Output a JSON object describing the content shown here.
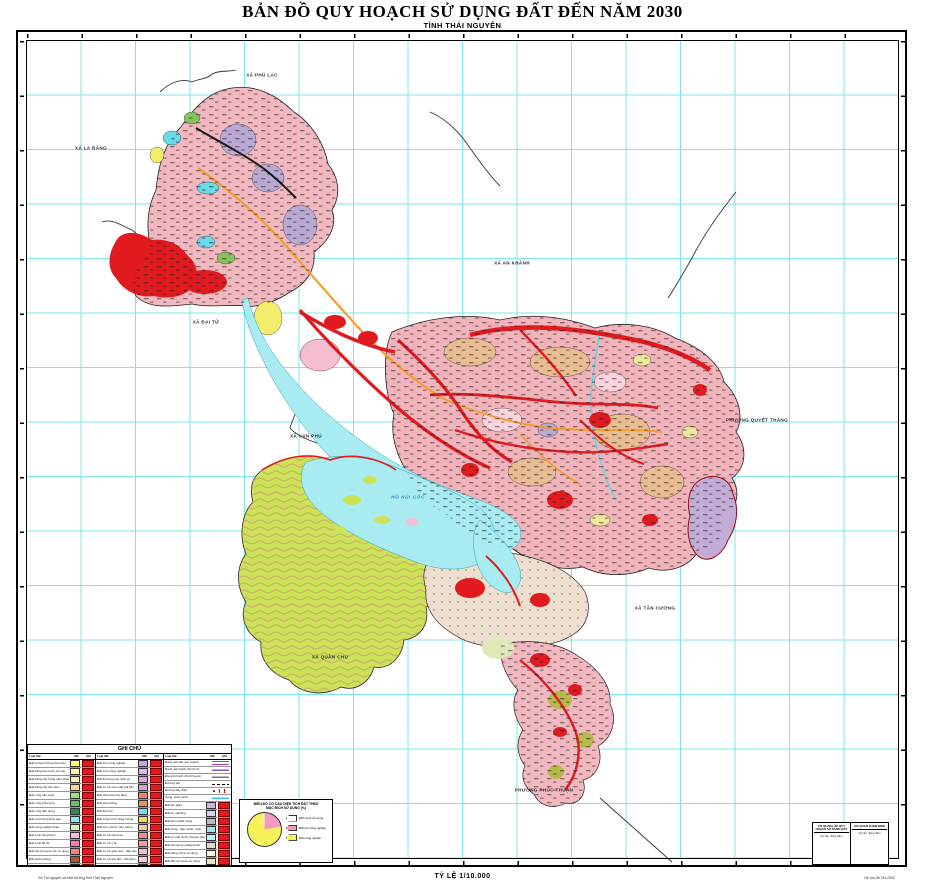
{
  "title": "BẢN ĐỒ QUY HOẠCH SỬ DỤNG ĐẤT ĐẾN NĂM 2030",
  "subtitle": "TỈNH THÁI NGUYÊN",
  "scale_text": "TỶ LỆ 1/10.000",
  "fineprint_left": "Sở Tài nguyên và Môi trường tỉnh Thái Nguyên",
  "fineprint_right": "Hệ tọa độ VN-2000",
  "colors": {
    "grid_line": "#7de7ee",
    "water": "#a8ecf2",
    "residential_pink": "#f3b6bd",
    "development_red": "#e11a20",
    "forest_green": "#cbe356",
    "purple_patch": "#b9a9d3",
    "orange_road": "#f59d2c"
  },
  "map": {
    "labels": [
      {
        "text": "XÃ PHÚ LẠC",
        "x": 262,
        "y": 75,
        "water": false
      },
      {
        "text": "XÃ LA BẰNG",
        "x": 91,
        "y": 148,
        "water": false
      },
      {
        "text": "XÃ AN KHÁNH",
        "x": 512,
        "y": 263,
        "water": false
      },
      {
        "text": "XÃ ĐẠI TỪ",
        "x": 206,
        "y": 322,
        "water": false
      },
      {
        "text": "XÃ VẠN PHÚ",
        "x": 306,
        "y": 436,
        "water": false
      },
      {
        "text": "PHƯỜNG QUYẾT THẮNG",
        "x": 757,
        "y": 420,
        "water": false
      },
      {
        "text": "XÃ TÂN CƯƠNG",
        "x": 655,
        "y": 608,
        "water": false
      },
      {
        "text": "XÃ QUÂN CHU",
        "x": 330,
        "y": 657,
        "water": false
      },
      {
        "text": "PHƯỜNG PHÚC THUẬN",
        "x": 544,
        "y": 790,
        "water": false
      },
      {
        "text": "HỒ NÚI CỐC",
        "x": 408,
        "y": 497,
        "water": true
      }
    ]
  },
  "legend": {
    "title": "GHI CHÚ",
    "col_headers": [
      "Loại đất",
      "Mã",
      "QH"
    ],
    "groups": [
      {
        "items": [
          {
            "label": "Đất chuyên trồng lúa nước",
            "color": "#ffff5e"
          },
          {
            "label": "Đất trồng lúa nước còn lại",
            "color": "#fff9a6"
          },
          {
            "label": "Đất trồng cây hàng năm khác",
            "color": "#ffedb0"
          },
          {
            "label": "Đất trồng cây lâu năm",
            "color": "#ffd29b"
          },
          {
            "label": "Đất rừng sản xuất",
            "color": "#9ee07d"
          },
          {
            "label": "Đất rừng phòng hộ",
            "color": "#63c063"
          },
          {
            "label": "Đất rừng đặc dụng",
            "color": "#2e8b57"
          },
          {
            "label": "Đất nuôi trồng thủy sản",
            "color": "#8fe7f5"
          },
          {
            "label": "Đất nông nghiệp khác",
            "color": "#d9efb5"
          },
          {
            "label": "Đất ở tại nông thôn",
            "color": "#ffb7de"
          },
          {
            "label": "Đất ở tại đô thị",
            "color": "#ff79b0"
          },
          {
            "label": "Đất xây dựng trụ sở cơ quan",
            "color": "#ff8080"
          },
          {
            "label": "Đất quốc phòng",
            "color": "#b0552f"
          },
          {
            "label": "Đất an ninh",
            "color": "#c96a6a"
          }
        ]
      },
      {
        "items": [
          {
            "label": "Đất khu công nghiệp",
            "color": "#c9a2ea"
          },
          {
            "label": "Đất cụm công nghiệp",
            "color": "#d7b9f2"
          },
          {
            "label": "Đất thương mại, dịch vụ",
            "color": "#f29ae4"
          },
          {
            "label": "Đất cơ sở sản xuất phi NN",
            "color": "#d6a3cc"
          },
          {
            "label": "Đất phát triển hạ tầng",
            "color": "#f0826e"
          },
          {
            "label": "Đất giao thông",
            "color": "#e6954e"
          },
          {
            "label": "Đất thủy lợi",
            "color": "#7edcf2"
          },
          {
            "label": "Đất công trình năng lượng",
            "color": "#ffd35c"
          },
          {
            "label": "Đất bưu chính, viễn thông",
            "color": "#f2cda3"
          },
          {
            "label": "Đất cơ sở văn hóa",
            "color": "#f28f8f"
          },
          {
            "label": "Đất cơ sở y tế",
            "color": "#ff97a3"
          },
          {
            "label": "Đất cơ sở giáo dục - đào tạo",
            "color": "#ffb7cb"
          },
          {
            "label": "Đất cơ sở thể dục - thể thao",
            "color": "#ffcbd6"
          },
          {
            "label": "Đất chợ",
            "color": "#f2b578"
          }
        ]
      },
      {
        "items": [
          {
            "label": "Ranh giới lập quy hoạch",
            "symbol": "line-purple"
          },
          {
            "label": "Ranh giới hành chính xã",
            "symbol": "line-violet"
          },
          {
            "label": "Địa giới hành chính huyện",
            "symbol": "line-gray"
          },
          {
            "label": "Đường sắt",
            "symbol": "dash-black"
          },
          {
            "label": "Đường dây điện",
            "symbol": "dots-black"
          },
          {
            "label": "Sông, suối, kênh",
            "symbol": "line-cyan"
          },
          {
            "label": "Đất tôn giáo",
            "color": "#cbb7e4"
          },
          {
            "label": "Đất tín ngưỡng",
            "color": "#d9cef2"
          },
          {
            "label": "Đất làm nghĩa trang",
            "color": "#b8b8b8"
          },
          {
            "label": "Đất sông, ngòi, kênh, rạch",
            "color": "#a3e4f2"
          },
          {
            "label": "Đất có mặt nước chuyên dùng",
            "color": "#baf2fa"
          },
          {
            "label": "Đất phi nông nghiệp khác",
            "color": "#e4d6cb"
          },
          {
            "label": "Đất bằng chưa sử dụng",
            "color": "#f7f7dc"
          },
          {
            "label": "Đất đồi núi chưa sử dụng",
            "color": "#e4e4b8"
          }
        ]
      }
    ]
  },
  "pie": {
    "title1": "BIỂU ĐỒ CƠ CẤU DIỆN TÍCH ĐẤT THEO",
    "title2": "MỤC ĐÍCH SỬ DỤNG (%)",
    "slices": [
      {
        "label": "Đất phi nông nghiệp",
        "pct": 22,
        "color": "#f49ac1"
      },
      {
        "label": "Đất nông nghiệp",
        "pct": 77,
        "color": "#f7f25a"
      },
      {
        "label": "Đất chưa sử dụng",
        "pct": 1,
        "color": "#ffffff"
      }
    ],
    "legend": [
      {
        "label": "Đất chưa sử dụng",
        "color": "#ffffff"
      },
      {
        "label": "Đất phi nông nghiệp",
        "color": "#f49ac1"
      },
      {
        "label": "Đất nông nghiệp",
        "color": "#f7f25a"
      }
    ]
  },
  "signature": {
    "left_header": "CƠ QUAN LẬP QUY HOẠCH SỬ DỤNG ĐẤT",
    "left_body": "(Ký tên, đóng dấu)",
    "right_header": "CƠ QUAN THẨM ĐỊNH",
    "right_body": "(Ký tên, đóng dấu)"
  }
}
